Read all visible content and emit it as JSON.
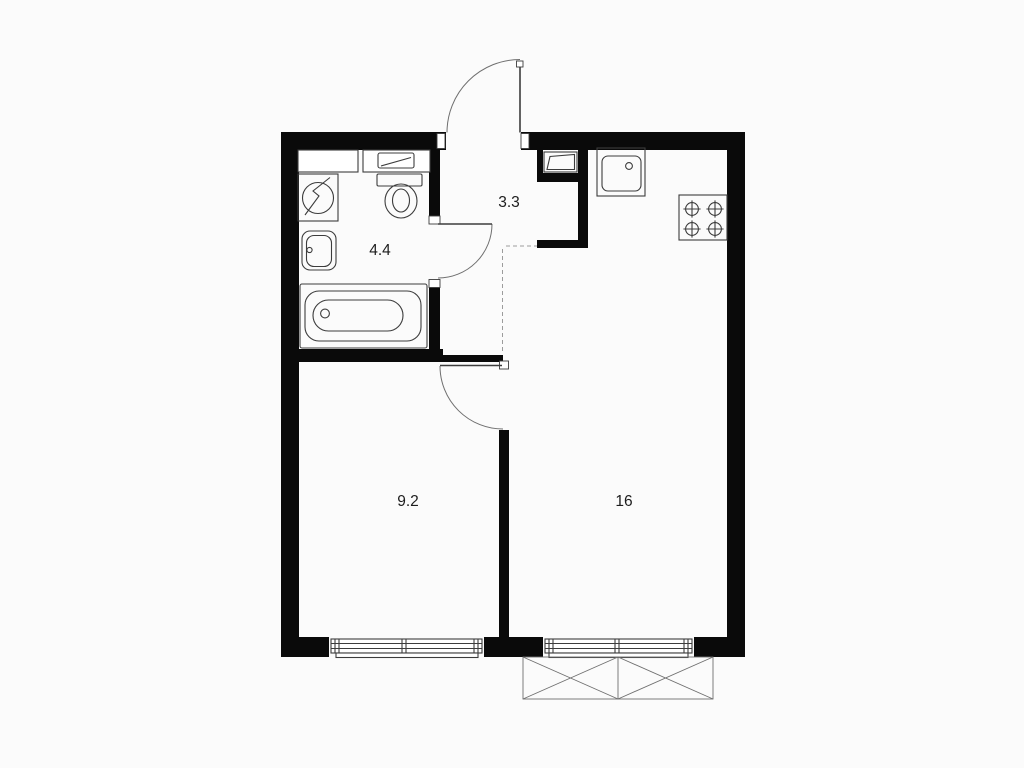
{
  "page": {
    "kind": "apartment-floor-plan"
  },
  "colors": {
    "bg": "#fbfbfb",
    "paper": "#ffffff",
    "wall": "#0a0a0a",
    "line": "#3c3c3c",
    "soft": "#6f6f6f",
    "dash": "#9c9c9c",
    "label": "#1d1d1d"
  },
  "rooms": [
    {
      "name": "bathroom",
      "area": "4.4"
    },
    {
      "name": "hallway",
      "area": "3.3"
    },
    {
      "name": "bedroom",
      "area": "9.2"
    },
    {
      "name": "living-kitchen",
      "area": "16"
    }
  ],
  "fixtures": [
    "washing-machine-icon",
    "washbasin-icon",
    "bathtub-icon",
    "toilet-icon",
    "bathroom-counter",
    "utility-panel-icon",
    "kitchen-sink-icon",
    "stove-icon",
    "entrance-door",
    "bathroom-door",
    "bedroom-door",
    "window",
    "window",
    "balcony"
  ]
}
